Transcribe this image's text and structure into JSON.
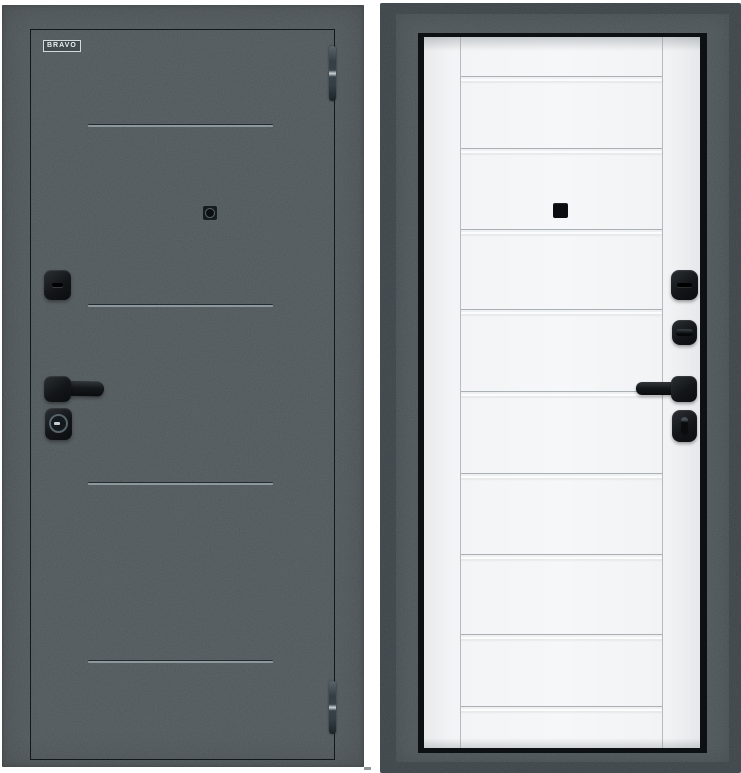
{
  "image": {
    "kind": "product-photo",
    "subject": "steel entry door shown from both sides",
    "left_view": "graphite interior slab",
    "right_view": "white exterior leaf in door frame"
  },
  "brand": {
    "logo_text": "BRAVO"
  },
  "colors": {
    "background": "#ffffff",
    "slab_graphite": "#404a4f",
    "frame_outer": "#252f35",
    "frame_mid": "#3c474d",
    "frame_border": "#0d1114",
    "leaf_white": "#f4f5f6",
    "hardware_black": "#121518",
    "groove_highlight": "#8d989c"
  },
  "left_door": {
    "grooves_count": 4,
    "hinges_count": 2,
    "hardware": [
      "deadbolt-cover",
      "lever-handle",
      "cylinder-escutcheon",
      "peephole"
    ]
  },
  "right_door": {
    "horizontal_strips_count": 9,
    "hardware": [
      "deadbolt-cover",
      "thumbturn-upper",
      "lever-handle",
      "thumbturn-lower",
      "peephole"
    ]
  }
}
